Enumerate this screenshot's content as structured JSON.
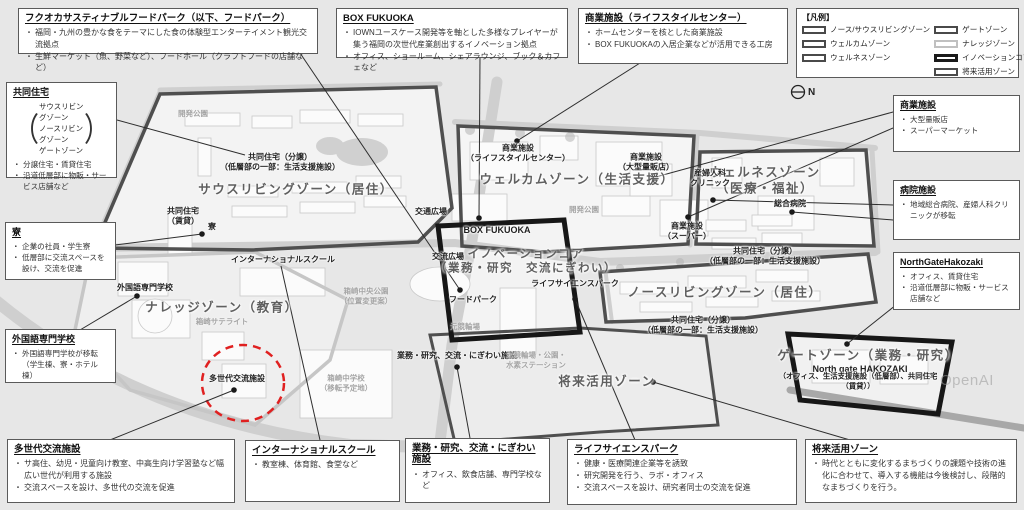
{
  "legend": {
    "title": "【凡例】",
    "items": [
      {
        "label": "ノース/サウスリビングゾーン",
        "border": "#4a4a4a"
      },
      {
        "label": "ウェルカムゾーン",
        "border": "#4a4a4a"
      },
      {
        "label": "ウェルネスゾーン",
        "border": "#4a4a4a"
      },
      {
        "label": "ゲートゾーン",
        "border": "#4a4a4a"
      },
      {
        "label": "ナレッジゾーン",
        "border": "#c0c0c0"
      },
      {
        "label": "イノベーションコア",
        "border": "#1a1a1a"
      },
      {
        "label": "将来活用ゾーン",
        "border": "#4a4a4a"
      }
    ]
  },
  "compass": {
    "label": "N"
  },
  "watermark": "OpenAI",
  "accent_red": "#e02020",
  "callouts": {
    "food_park": {
      "title": "フクオカサスティナブルフードパーク（以下、フードパーク）",
      "bullets": [
        "福岡・九州の豊かな食をテーマにした食の体験型エンターテイメント観光交流拠点",
        "生鮮マーケット（魚、野菜など）、フードホール（クラフトフードの店舗など）"
      ]
    },
    "box_fukuoka": {
      "title": "BOX FUKUOKA",
      "bullets": [
        "IOWNユースケース開発等を軸とした多様なプレイヤーが集う福岡の次世代産業創出するイノベーション拠点",
        "オフィス、ショールーム、シェアラウンジ、ブック＆カフェなど"
      ]
    },
    "commercial_lifestyle": {
      "title": "商業施設（ライフスタイルセンター）",
      "bullets": [
        "ホームセンターを核とした商業施設",
        "BOX FUKUOKAの入居企業などが活用できる工房"
      ]
    },
    "kyodo_jutaku": {
      "title": "共同住宅",
      "zones": [
        "サウスリビングゾーン",
        "ノースリビングゾーン",
        "ゲートゾーン"
      ],
      "bullets": [
        "分譲住宅・賃貸住宅",
        "沿道低層部に物販・サービス店舗など"
      ]
    },
    "ryo": {
      "title": "寮",
      "bullets": [
        "企業の社員・学生寮",
        "低層部に交流スペースを設け、交流を促進"
      ]
    },
    "gaikokugo": {
      "title": "外国語専門学校",
      "bullets": [
        "外国語専門学校が移転（学生棟、寮・ホテル棟）"
      ]
    },
    "tasedai": {
      "title": "多世代交流施設",
      "bullets": [
        "サ高住、幼児・児童向け教室、中高生向け学習塾など幅広い世代が利用する施設",
        "交流スペースを設け、多世代の交流を促進"
      ]
    },
    "international_school": {
      "title": "インターナショナルスクール",
      "bullets": [
        "教室棟、体育館、食堂など"
      ]
    },
    "gyomu": {
      "title": "業務・研究、交流・にぎわい施設",
      "bullets": [
        "オフィス、飲食店舗、専門学校など"
      ]
    },
    "life_science": {
      "title": "ライフサイエンスパーク",
      "bullets": [
        "健康・医療関連企業等を誘致",
        "研究開発を行う、ラボ・オフィス",
        "交流スペースを設け、研究者同士の交流を促進"
      ]
    },
    "future_zone": {
      "title": "将来活用ゾーン",
      "bullets": [
        "時代とともに変化するまちづくりの課題や技術の進化に合わせて、導入する機能は今後検討し、段階的なまちづくりを行う。"
      ]
    },
    "commercial_right": {
      "title": "商業施設",
      "bullets": [
        "大型量販店",
        "スーパーマーケット"
      ]
    },
    "hospital": {
      "title": "病院施設",
      "bullets": [
        "地域総合病院、産婦人科クリニックが移転"
      ]
    },
    "north_gate": {
      "title": "NorthGateHakozaki",
      "bullets": [
        "オフィス、賃貸住宅",
        "沿道低層部に物販・サービス店舗など"
      ]
    }
  },
  "map": {
    "zone_labels": {
      "south_living": "サウスリビングゾーン（居住）",
      "welcome": "ウェルカムゾーン（生活支援）",
      "wellness": "ウェルネスゾーン\n（医療・福祉）",
      "innovation": "イノベーションコア\n（業務・研究　交流にぎわい）",
      "north_living": "ノースリビングゾーン（居住）",
      "gate": "ゲートゾーン（業務・研究）",
      "knowledge": "ナレッジゾーン（教育）",
      "future": "将来活用ゾーン"
    },
    "facility_labels": {
      "kyodo_bunjo_south": "共同住宅（分譲）\n（低層部の一部：生活支援施設）",
      "kyodo_chintai": "共同住宅\n（賃貸）",
      "ryo": "寮",
      "intl_school": "インターナショナルスクール",
      "kotsu_hiroba": "交通広場",
      "koryu_hiroba": "交流広場",
      "shogyo_lsc": "商業施設\n（ライフスタイルセンター）",
      "box_fukuoka": "BOX FUKUOKA",
      "food_park": "フードパーク",
      "shogyo_ryohan": "商業施設\n（大型量販店）",
      "shogyo_super": "商業施設\n（スーパー）",
      "sanfujinka": "産婦人科\nクリニック",
      "sogo_byoin": "総合病院",
      "kyodo_bunjo_ne": "共同住宅（分譲）\n（低層部の一部：生活支援施設）",
      "kyodo_bunjo_n": "共同住宅（分譲）\n（低層部の一部：生活支援施設）",
      "life_science": "ライフサイエンスパーク",
      "gyomu": "業務・研究、交流・にぎわい施設",
      "tasedai": "多世代交流施設",
      "gaikokugo": "外国語専門学校",
      "north_gate_en": "North gate HAKOZAKI",
      "north_gate_sub": "（オフィス、生活支援施設（低層部）、共同住宅（賃貸））"
    },
    "area_labels": {
      "kaihatsu_koen_w": "開発公園",
      "kaihatsu_koen_c": "開発公園",
      "satellite": "箱崎サテライト",
      "chuo_koen": "箱崎中央公園\n（位置変更案）",
      "chugakko": "箱崎中学校\n（移転予定地）",
      "moto_keirin": "元競輪場",
      "moto_keirin2": "元競輪場・公園・\n水素ステーション"
    }
  }
}
